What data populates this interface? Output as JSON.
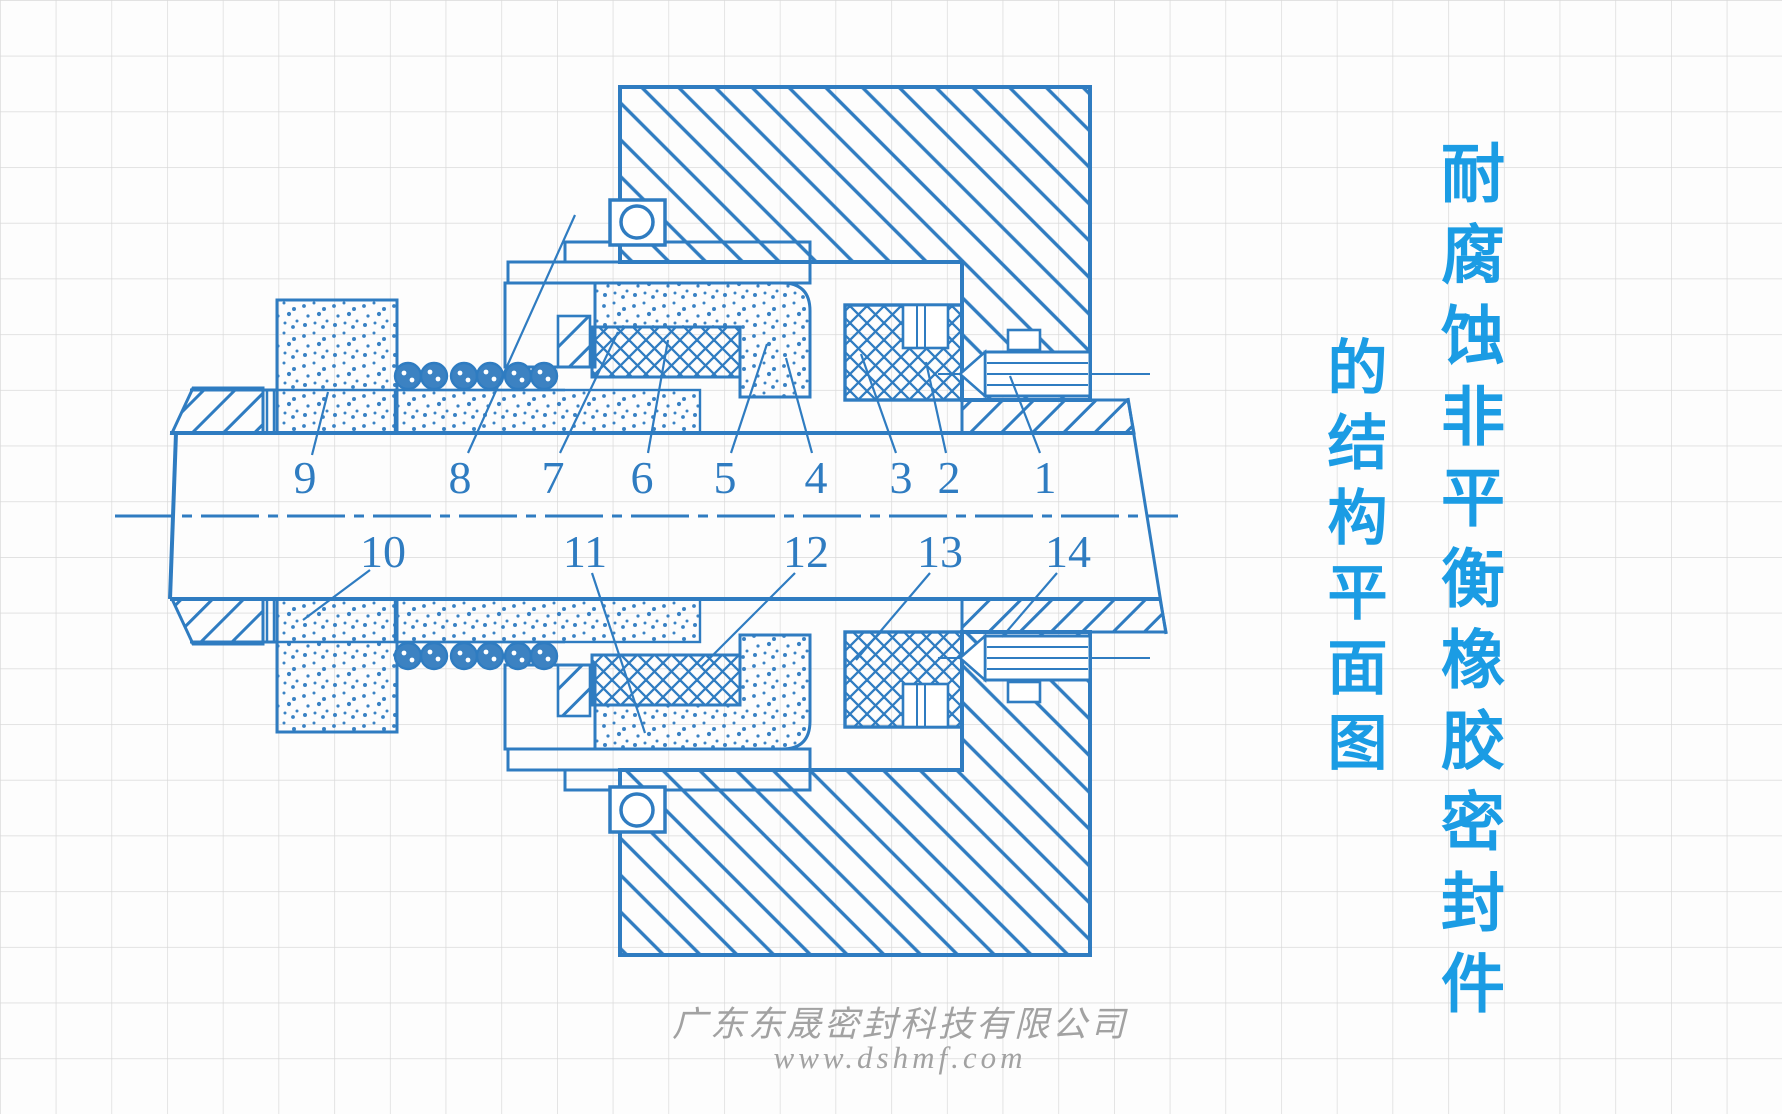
{
  "title": {
    "line1": "耐腐蚀非平衡橡胶密封件",
    "line2": "的结构平面图",
    "color": "#1b9ce4"
  },
  "watermark": {
    "company": "广东东晟密封科技有限公司",
    "website": "www.dshmf.com",
    "color": "#a2a2a2"
  },
  "diagram": {
    "description": "Cross-section engineering drawing of a corrosion-resistant unbalanced rubber mechanical seal on graph paper",
    "line_color": "#2f7cc1",
    "grid_color": "#d9d9d9",
    "part_numbers_top": [
      "9",
      "8",
      "7",
      "6",
      "5",
      "4",
      "3",
      "2",
      "1"
    ],
    "part_numbers_bottom": [
      "10",
      "11",
      "12",
      "13",
      "14"
    ]
  }
}
